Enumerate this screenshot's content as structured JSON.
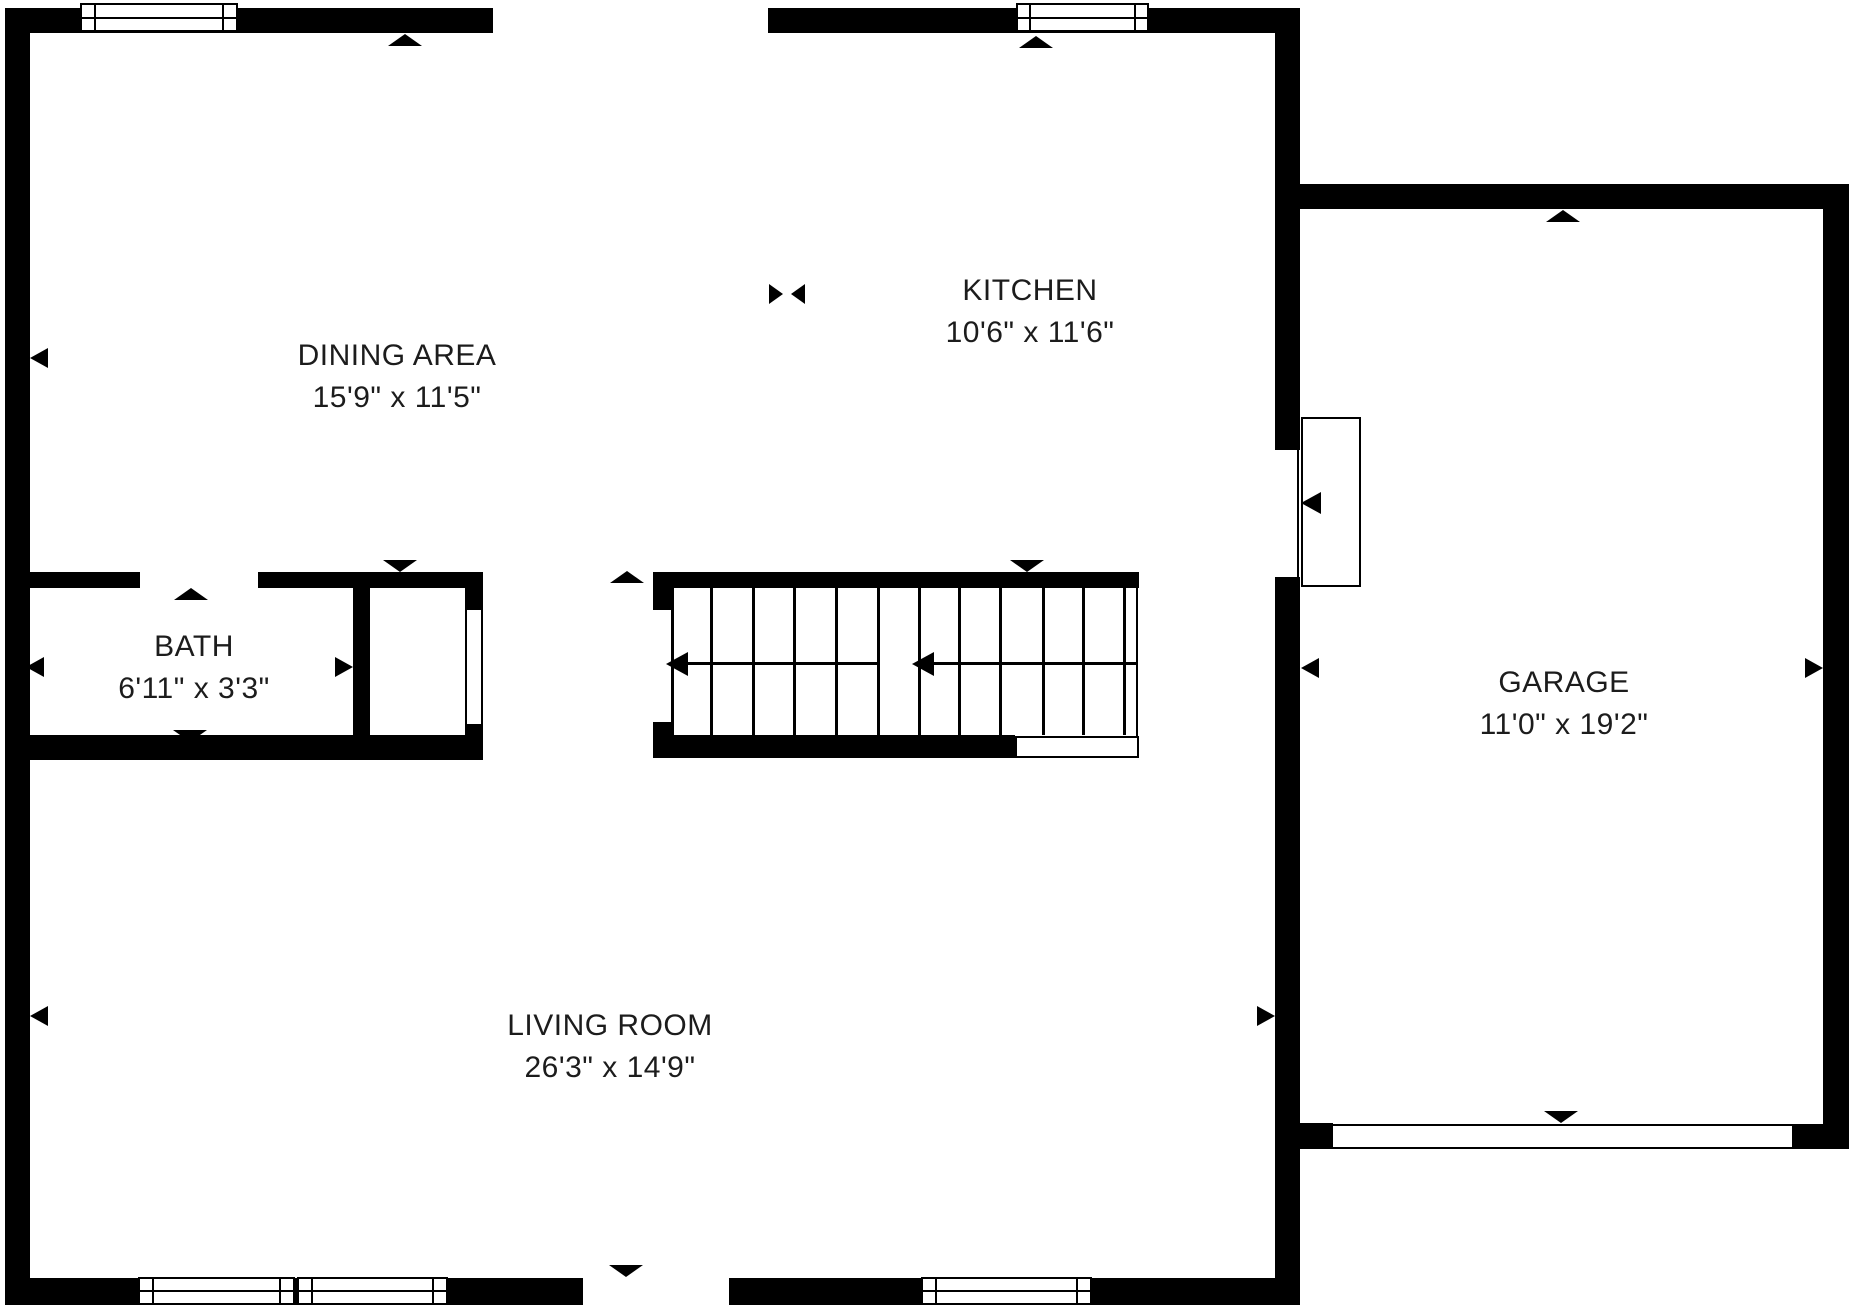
{
  "plan": {
    "background_color": "#ffffff",
    "wall_color": "#000000",
    "text_color": "#1c1c1c",
    "rooms": [
      {
        "name": "DINING AREA",
        "dims": "15'9\" x 11'5\""
      },
      {
        "name": "KITCHEN",
        "dims": "10'6\" x 11'6\""
      },
      {
        "name": "BATH",
        "dims": "6'11\" x 3'3\""
      },
      {
        "name": "GARAGE",
        "dims": "11'0\" x 19'2\""
      },
      {
        "name": "LIVING ROOM",
        "dims": "26'3\" x 14'9\""
      }
    ],
    "markers": {
      "up_triangle": "▲",
      "down_triangle": "▼",
      "left_triangle": "◀",
      "right_triangle": "▶",
      "bowtie": "▸◂"
    }
  }
}
